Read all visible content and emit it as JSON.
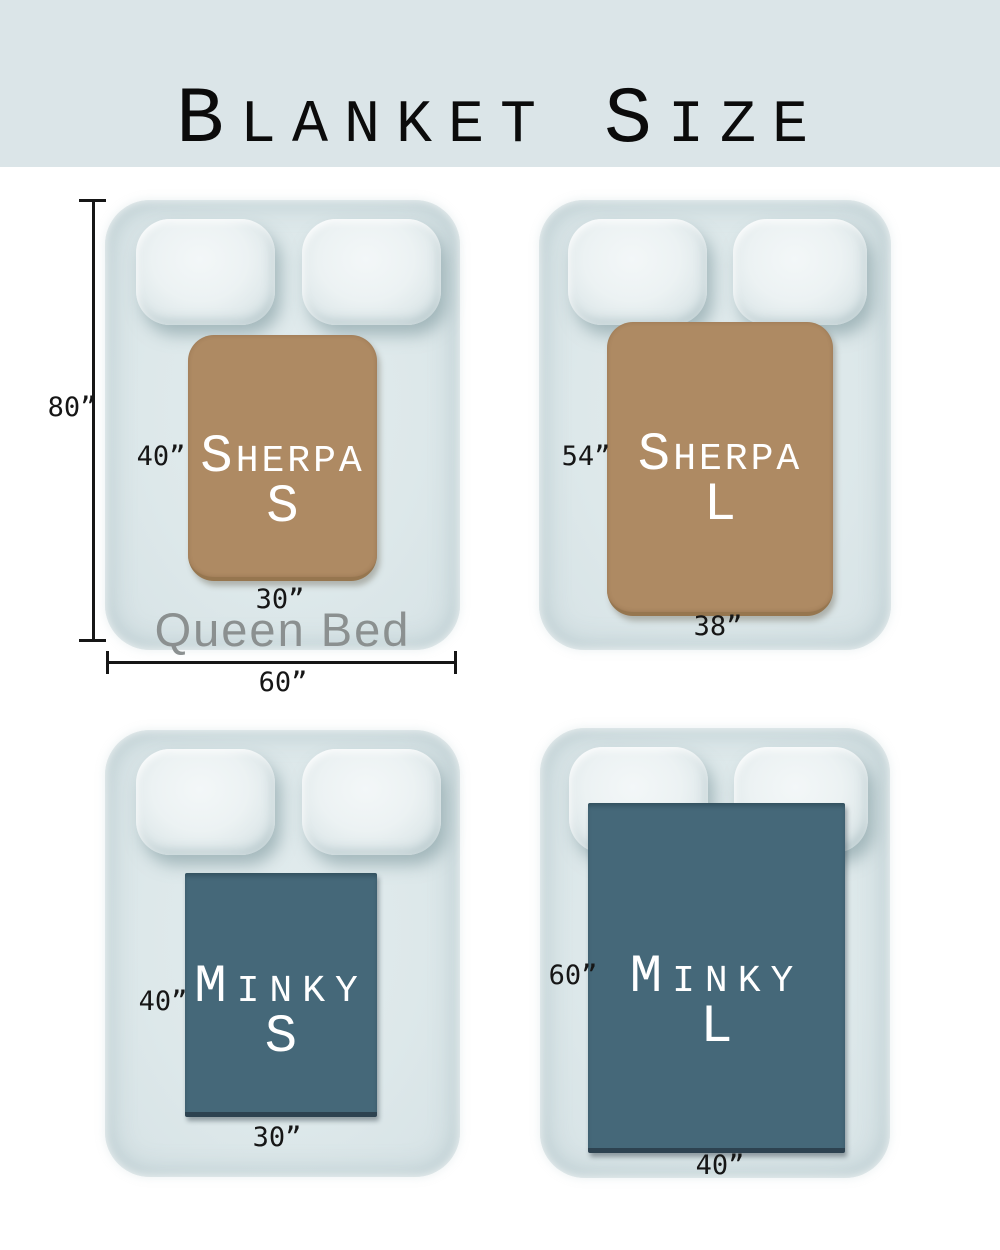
{
  "header": {
    "title": {
      "b1": "B",
      "s1": "LANKET",
      "b2": "S",
      "s2": "IZE"
    }
  },
  "queen_bed": {
    "name": "Queen Bed",
    "height_label": "80”",
    "width_label": "60”"
  },
  "blankets": {
    "sherpa_s": {
      "name_big": "S",
      "name_small": "HERPA",
      "size_letter": "S",
      "height_label": "40”",
      "width_label": "30”"
    },
    "sherpa_l": {
      "name_big": "S",
      "name_small": "HERPA",
      "size_letter": "L",
      "height_label": "54”",
      "width_label": "38”"
    },
    "minky_s": {
      "name_big": "M",
      "name_small": "INKY",
      "size_letter": "S",
      "height_label": "40”",
      "width_label": "30”"
    },
    "minky_l": {
      "name_big": "M",
      "name_small": "INKY",
      "size_letter": "L",
      "height_label": "60”",
      "width_label": "40”"
    }
  },
  "colors": {
    "header_bg": "#dbe5e8",
    "page_bg": "#ffffff",
    "bed_fill": "#dde8ea",
    "pillow_fill": "#ecf2f3",
    "sherpa_blanket": "#ae8a63",
    "sherpa_edge": "#96764f",
    "minky_blanket": "#456879",
    "minky_edge": "#2d4250",
    "blanket_text": "#ffffff",
    "measurement_text": "#161616",
    "queen_bed_text": "#8b9090",
    "title_text": "#0b0b0b"
  }
}
